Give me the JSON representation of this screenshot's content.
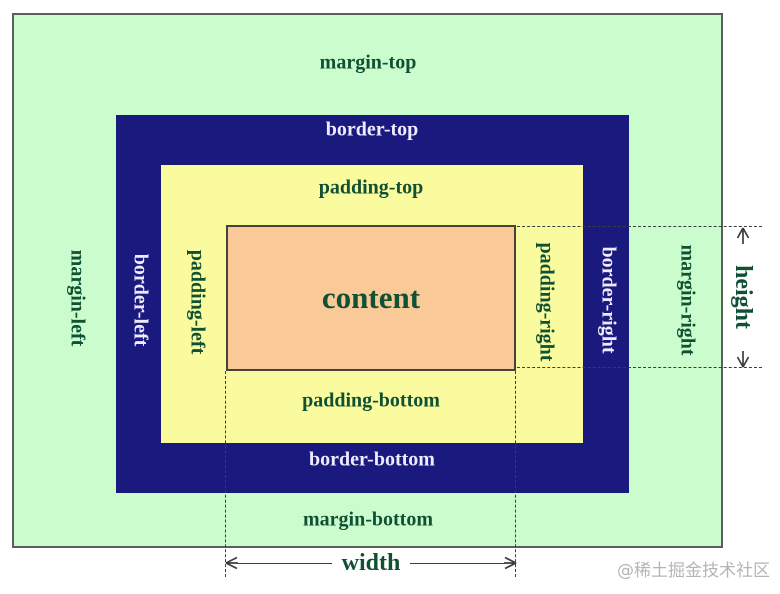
{
  "diagram": {
    "margin_top": "margin-top",
    "margin_bottom": "margin-bottom",
    "margin_left": "margin-left",
    "margin_right": "margin-right",
    "border_top": "border-top",
    "border_bottom": "border-bottom",
    "border_left": "border-left",
    "border_right": "border-right",
    "padding_top": "padding-top",
    "padding_bottom": "padding-bottom",
    "padding_left": "padding-left",
    "padding_right": "padding-right",
    "content": "content",
    "width": "width",
    "height": "height"
  },
  "watermark": "@稀土掘金技术社区",
  "colors": {
    "margin_bg": "#cbfccd",
    "border_bg": "#1a1a7e",
    "padding_bg": "#fafa9e",
    "content_bg": "#fac998",
    "label_green": "#0f5132",
    "label_light": "#efeaff",
    "line_color": "#3b3f3b",
    "outer_border": "#5a5f5a",
    "content_border": "#474239",
    "watermark_color": "#b5b5b5"
  }
}
